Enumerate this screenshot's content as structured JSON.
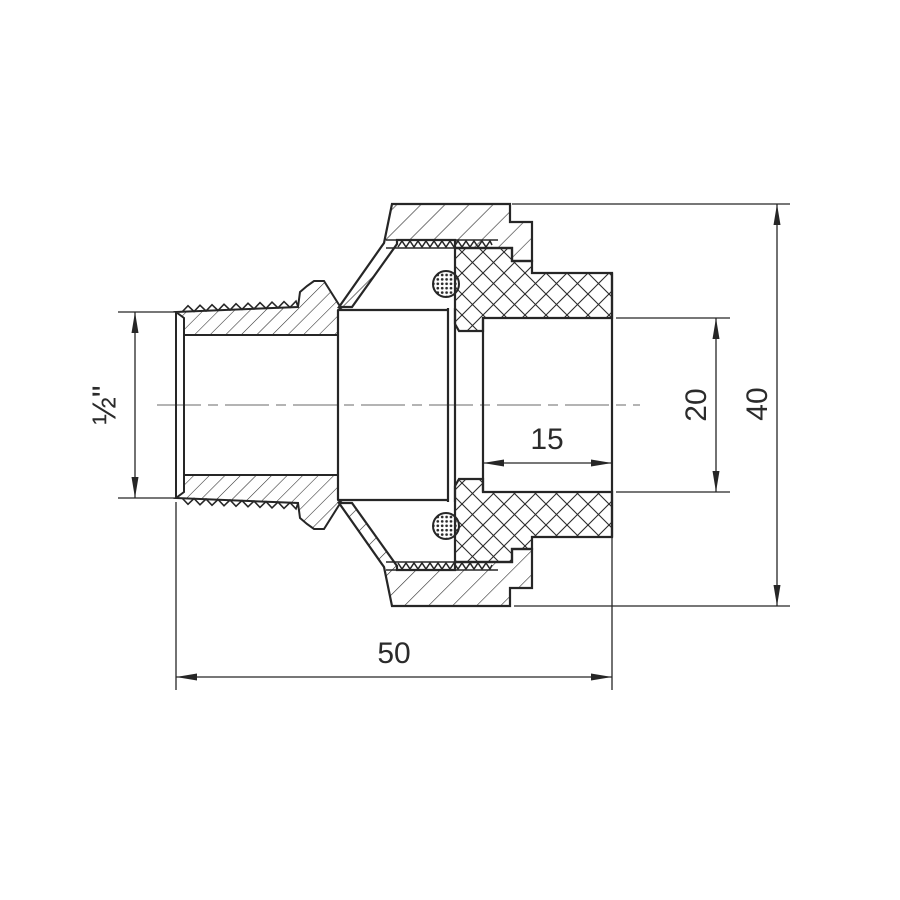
{
  "page": {
    "background": "#ffffff"
  },
  "drawing": {
    "title": "pipe-union-fitting-section",
    "description": "Cross-section technical drawing of a half-inch male thread pipe union fitting with union nut, socket insert and O-rings",
    "line_color": "#262626",
    "centerline_color": "#9c9c9c",
    "hatch_color": "#2b2b2b",
    "dimensions": {
      "thread_size": "½\"",
      "socket_depth": "15",
      "socket_inner_diameter": "20",
      "overall_height": "40",
      "overall_length": "50"
    }
  }
}
